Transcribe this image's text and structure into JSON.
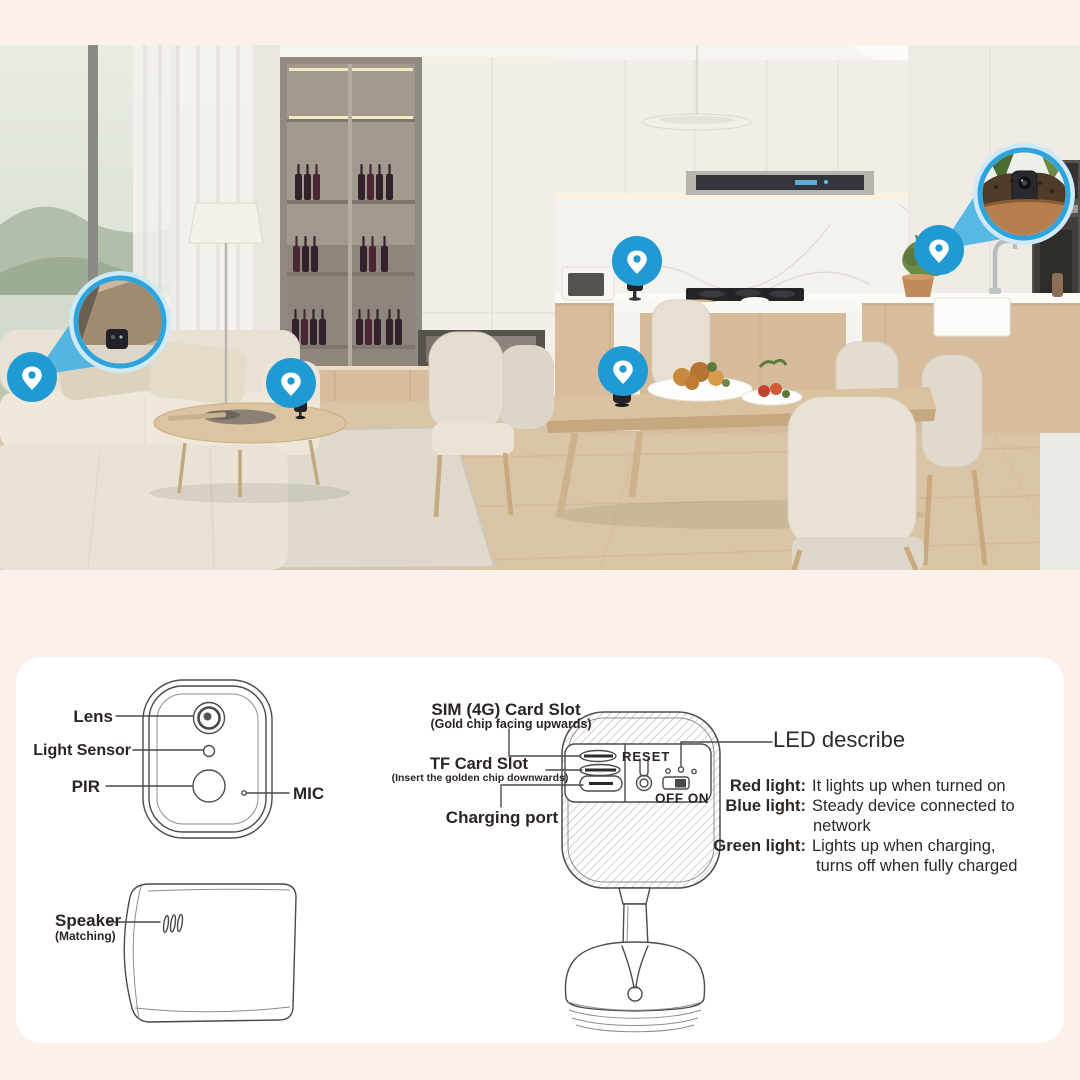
{
  "colors": {
    "page_bg": "#fcf1ea",
    "panel_bg": "#ffffff",
    "accent_blue": "#1f9ad3",
    "beam_blue": "#45b2e2",
    "ring_blue": "#2da4db",
    "diagram_line": "#4a4a4a",
    "label_text": "#2b2422"
  },
  "diagram": {
    "front": {
      "lens": "Lens",
      "light_sensor": "Light Sensor",
      "pir": "PIR",
      "mic": "MIC"
    },
    "side": {
      "speaker": "Speaker",
      "speaker_note": "(Matching)"
    },
    "back": {
      "sim_title": "SIM (4G) Card Slot",
      "sim_note": "(Gold chip facing upwards)",
      "tf_title": "TF Card Slot",
      "tf_note": "(Insert the golden chip downwards)",
      "charging": "Charging port",
      "reset": "RESET",
      "power": "OFF ON"
    },
    "led": {
      "title": "LED describe",
      "red_label": "Red light:",
      "red_text": "It lights up when turned on",
      "blue_label": "Blue light:",
      "blue_text": "Steady device connected to",
      "blue_cont": "network",
      "green_label": "Green light:",
      "green_text": "Lights up when charging,",
      "green_cont": "turns off when fully charged"
    }
  }
}
